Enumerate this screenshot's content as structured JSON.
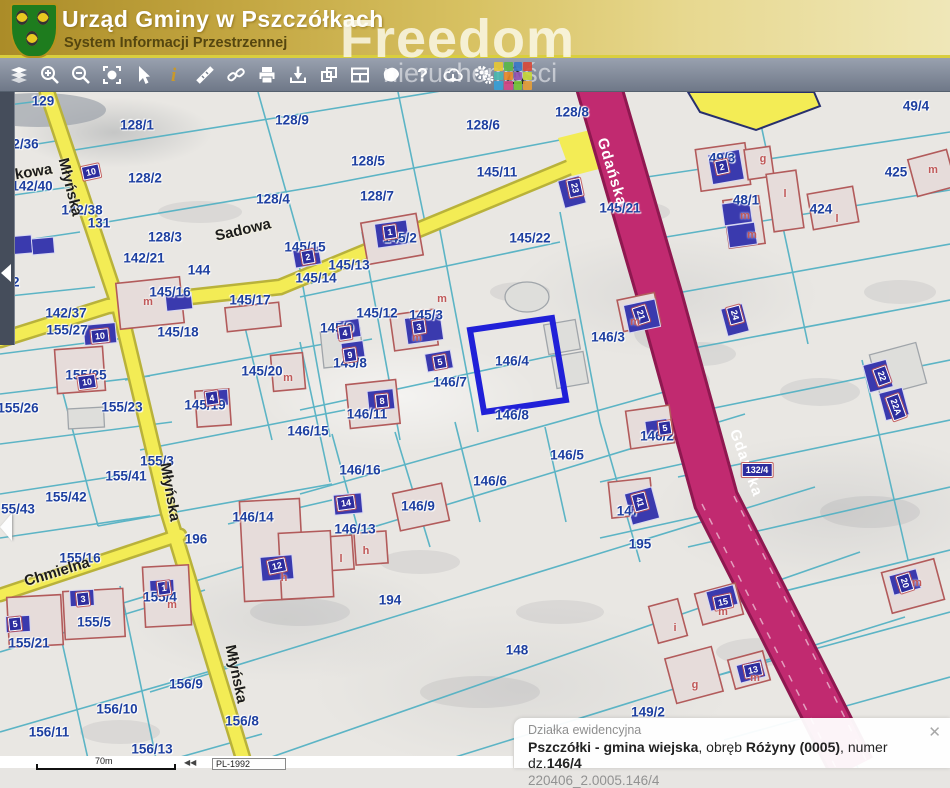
{
  "header": {
    "title": "Urząd Gminy w Pszczółkach",
    "subtitle": "System Informacji Przestrzennej"
  },
  "watermark": {
    "word1": "Freedom",
    "word2": "nieruchomości"
  },
  "toolbar": {
    "tools": [
      "layers",
      "zoom-in",
      "zoom-out",
      "zoom-extent",
      "pointer",
      "info",
      "measure",
      "link",
      "print",
      "download-marker",
      "windows",
      "layout",
      "polygon",
      "help",
      "cloud",
      "settings",
      "warning"
    ]
  },
  "map": {
    "selected_parcel": "146/4",
    "parcel_labels": [
      {
        "t": "129",
        "x": 43,
        "y": 101
      },
      {
        "t": "128/1",
        "x": 137,
        "y": 125
      },
      {
        "t": "128/9",
        "x": 292,
        "y": 120
      },
      {
        "t": "128/6",
        "x": 483,
        "y": 125
      },
      {
        "t": "128/8",
        "x": 572,
        "y": 112
      },
      {
        "t": "49/4",
        "x": 916,
        "y": 106
      },
      {
        "t": "142/36",
        "x": 18,
        "y": 144
      },
      {
        "t": "142/40",
        "x": 32,
        "y": 186
      },
      {
        "t": "128/2",
        "x": 145,
        "y": 178
      },
      {
        "t": "49/3",
        "x": 722,
        "y": 158
      },
      {
        "t": "425",
        "x": 896,
        "y": 172
      },
      {
        "t": "48/1",
        "x": 746,
        "y": 200
      },
      {
        "t": "424",
        "x": 821,
        "y": 209
      },
      {
        "t": "128/5",
        "x": 368,
        "y": 161
      },
      {
        "t": "128/7",
        "x": 377,
        "y": 196
      },
      {
        "t": "145/11",
        "x": 497,
        "y": 172
      },
      {
        "t": "145/21",
        "x": 620,
        "y": 208
      },
      {
        "t": "128/3",
        "x": 165,
        "y": 237
      },
      {
        "t": "128/4",
        "x": 273,
        "y": 199
      },
      {
        "t": "142/38",
        "x": 82,
        "y": 210
      },
      {
        "t": "131",
        "x": 99,
        "y": 223
      },
      {
        "t": "144",
        "x": 199,
        "y": 270
      },
      {
        "t": "145/15",
        "x": 305,
        "y": 247
      },
      {
        "t": "145/2",
        "x": 400,
        "y": 238
      },
      {
        "t": "145/13",
        "x": 349,
        "y": 265
      },
      {
        "t": "145/14",
        "x": 316,
        "y": 278
      },
      {
        "t": "145/22",
        "x": 530,
        "y": 238
      },
      {
        "t": "145/16",
        "x": 170,
        "y": 292
      },
      {
        "t": "145/17",
        "x": 250,
        "y": 300
      },
      {
        "t": "142/21",
        "x": 144,
        "y": 258
      },
      {
        "t": "22",
        "x": 12,
        "y": 282
      },
      {
        "t": "142/37",
        "x": 66,
        "y": 313
      },
      {
        "t": "155/27",
        "x": 67,
        "y": 330
      },
      {
        "t": "145/18",
        "x": 178,
        "y": 332
      },
      {
        "t": "145/12",
        "x": 377,
        "y": 313
      },
      {
        "t": "145/3",
        "x": 426,
        "y": 315
      },
      {
        "t": "145/9",
        "x": 337,
        "y": 328
      },
      {
        "t": "145/8",
        "x": 350,
        "y": 363
      },
      {
        "t": "145/20",
        "x": 262,
        "y": 371
      },
      {
        "t": "155/25",
        "x": 86,
        "y": 375
      },
      {
        "t": "155/26",
        "x": 18,
        "y": 408
      },
      {
        "t": "155/23",
        "x": 122,
        "y": 407
      },
      {
        "t": "145/19",
        "x": 205,
        "y": 405
      },
      {
        "t": "146/15",
        "x": 308,
        "y": 431
      },
      {
        "t": "146/11",
        "x": 367,
        "y": 414
      },
      {
        "t": "146/7",
        "x": 450,
        "y": 382
      },
      {
        "t": "146/4",
        "x": 512,
        "y": 361
      },
      {
        "t": "146/3",
        "x": 608,
        "y": 337
      },
      {
        "t": "146/8",
        "x": 512,
        "y": 415
      },
      {
        "t": "146/2",
        "x": 657,
        "y": 436
      },
      {
        "t": "146/5",
        "x": 567,
        "y": 455
      },
      {
        "t": "146/6",
        "x": 490,
        "y": 481
      },
      {
        "t": "146/16",
        "x": 360,
        "y": 470
      },
      {
        "t": "155/3",
        "x": 157,
        "y": 461
      },
      {
        "t": "155/41",
        "x": 126,
        "y": 476
      },
      {
        "t": "155/42",
        "x": 66,
        "y": 497
      },
      {
        "t": "55/43",
        "x": 18,
        "y": 509
      },
      {
        "t": "146/9",
        "x": 418,
        "y": 506
      },
      {
        "t": "146/14",
        "x": 253,
        "y": 517
      },
      {
        "t": "146/13",
        "x": 355,
        "y": 529
      },
      {
        "t": "196",
        "x": 196,
        "y": 539
      },
      {
        "t": "155/16",
        "x": 80,
        "y": 558
      },
      {
        "t": "155/4",
        "x": 160,
        "y": 597
      },
      {
        "t": "155/5",
        "x": 94,
        "y": 622
      },
      {
        "t": "155/21",
        "x": 29,
        "y": 643
      },
      {
        "t": "147",
        "x": 628,
        "y": 511
      },
      {
        "t": "195",
        "x": 640,
        "y": 544
      },
      {
        "t": "156/9",
        "x": 186,
        "y": 684
      },
      {
        "t": "156/10",
        "x": 117,
        "y": 709
      },
      {
        "t": "156/11",
        "x": 49,
        "y": 732
      },
      {
        "t": "156/13",
        "x": 152,
        "y": 749
      },
      {
        "t": "156/8",
        "x": 242,
        "y": 721
      },
      {
        "t": "194",
        "x": 390,
        "y": 600
      },
      {
        "t": "148",
        "x": 517,
        "y": 650
      },
      {
        "t": "149/2",
        "x": 648,
        "y": 712
      }
    ],
    "street_labels": [
      {
        "t": "Sadowa",
        "x": 243,
        "y": 230,
        "r": -13
      },
      {
        "t": "mkowa",
        "x": 27,
        "y": 173,
        "r": -9
      },
      {
        "t": "Młyńska",
        "x": 70,
        "y": 187,
        "r": 76
      },
      {
        "t": "Młyńska",
        "x": 170,
        "y": 492,
        "r": 80
      },
      {
        "t": "Młyńska",
        "x": 236,
        "y": 674,
        "r": 78
      },
      {
        "t": "Chmielna",
        "x": 57,
        "y": 572,
        "r": -17
      }
    ],
    "road_labels": [
      {
        "t": "Gdańska",
        "x": 612,
        "y": 172,
        "r": 73
      },
      {
        "t": "Gdańska",
        "x": 746,
        "y": 463,
        "r": 70
      }
    ],
    "address_badges": [
      {
        "t": "10",
        "x": 91,
        "y": 172,
        "r": -12
      },
      {
        "t": "10",
        "x": 100,
        "y": 336,
        "r": -6
      },
      {
        "t": "2",
        "x": 308,
        "y": 257,
        "r": -10
      },
      {
        "t": "1",
        "x": 390,
        "y": 232,
        "r": -8
      },
      {
        "t": "23",
        "x": 575,
        "y": 188,
        "r": 78
      },
      {
        "t": "24",
        "x": 735,
        "y": 315,
        "r": 75
      },
      {
        "t": "2",
        "x": 722,
        "y": 167,
        "r": -12
      },
      {
        "t": "21",
        "x": 641,
        "y": 315,
        "r": 72
      },
      {
        "t": "3",
        "x": 419,
        "y": 327,
        "r": -8
      },
      {
        "t": "4",
        "x": 345,
        "y": 333,
        "r": -8
      },
      {
        "t": "9",
        "x": 350,
        "y": 355,
        "r": -8
      },
      {
        "t": "5",
        "x": 440,
        "y": 362,
        "r": -10
      },
      {
        "t": "8",
        "x": 382,
        "y": 401,
        "r": -6
      },
      {
        "t": "12",
        "x": 277,
        "y": 566,
        "r": -12
      },
      {
        "t": "3",
        "x": 83,
        "y": 599,
        "r": -6
      },
      {
        "t": "5",
        "x": 15,
        "y": 624,
        "r": -6
      },
      {
        "t": "1",
        "x": 164,
        "y": 588,
        "r": -8
      },
      {
        "t": "14",
        "x": 346,
        "y": 503,
        "r": -8
      },
      {
        "t": "41",
        "x": 640,
        "y": 502,
        "r": 75
      },
      {
        "t": "22",
        "x": 882,
        "y": 376,
        "r": 70
      },
      {
        "t": "22A",
        "x": 896,
        "y": 407,
        "r": 70
      },
      {
        "t": "20",
        "x": 905,
        "y": 583,
        "r": 72
      },
      {
        "t": "15",
        "x": 723,
        "y": 602,
        "r": -12
      },
      {
        "t": "13",
        "x": 753,
        "y": 670,
        "r": -12
      },
      {
        "t": "5",
        "x": 665,
        "y": 428,
        "r": -8
      },
      {
        "t": "4",
        "x": 212,
        "y": 398,
        "r": -8
      },
      {
        "t": "10",
        "x": 87,
        "y": 382,
        "r": -8
      },
      {
        "t": "132/4",
        "x": 757,
        "y": 470,
        "r": 0
      }
    ],
    "building_letters": [
      {
        "t": "m",
        "x": 148,
        "y": 302
      },
      {
        "t": "m",
        "x": 288,
        "y": 378
      },
      {
        "t": "m",
        "x": 417,
        "y": 338
      },
      {
        "t": "m",
        "x": 442,
        "y": 299
      },
      {
        "t": "m",
        "x": 635,
        "y": 322
      },
      {
        "t": "m",
        "x": 745,
        "y": 216
      },
      {
        "t": "m",
        "x": 752,
        "y": 235
      },
      {
        "t": "g",
        "x": 763,
        "y": 159
      },
      {
        "t": "l",
        "x": 837,
        "y": 219
      },
      {
        "t": "l",
        "x": 785,
        "y": 194
      },
      {
        "t": "m",
        "x": 933,
        "y": 170
      },
      {
        "t": "h",
        "x": 284,
        "y": 578
      },
      {
        "t": "l",
        "x": 166,
        "y": 586
      },
      {
        "t": "m",
        "x": 172,
        "y": 605
      },
      {
        "t": "l",
        "x": 341,
        "y": 559
      },
      {
        "t": "h",
        "x": 366,
        "y": 551
      },
      {
        "t": "i",
        "x": 675,
        "y": 628
      },
      {
        "t": "m",
        "x": 723,
        "y": 612
      },
      {
        "t": "g",
        "x": 695,
        "y": 685
      },
      {
        "t": "m",
        "x": 755,
        "y": 678
      },
      {
        "t": "m",
        "x": 917,
        "y": 583
      }
    ]
  },
  "info_panel": {
    "title": "Działka ewidencyjna",
    "bold1": "Pszczółki - gmina wiejska",
    "mid1": ", obręb ",
    "bold2": "Różyny (0005)",
    "mid2": ", numer dz.",
    "bold3": "146/4",
    "code": "220406_2.0005.146/4",
    "close": "✕"
  },
  "statusbar": {
    "scale": "70m",
    "crs": "PL-1992"
  },
  "colors": {
    "parcel_line": "#55b2c4",
    "parcel_text": "#1d3fa0",
    "road_yellow": "#f3ec55",
    "road_magenta": "#c12a70",
    "selection_blue": "#2020d8",
    "building_red": "#b25b5b",
    "badge_navy": "#2d2d9e"
  }
}
